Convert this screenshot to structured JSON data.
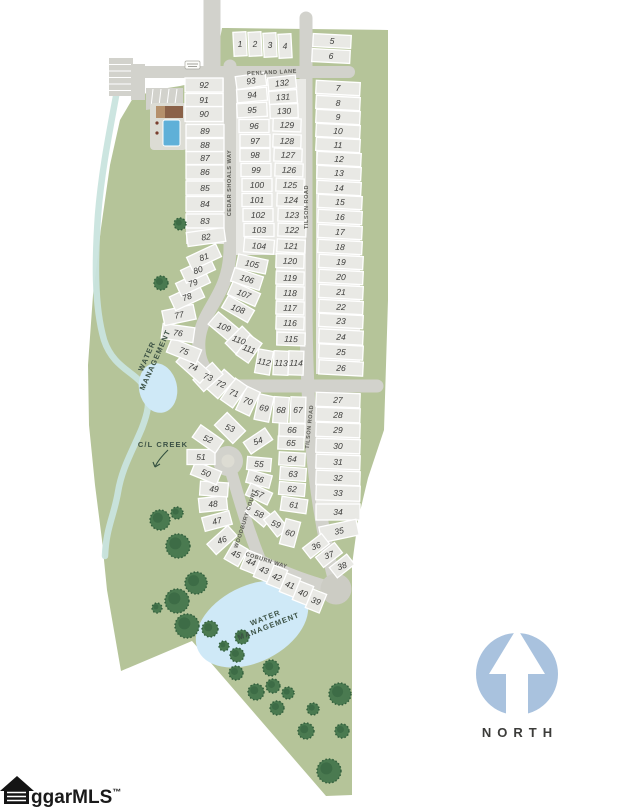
{
  "map": {
    "streets": [
      {
        "text": "PENLAND LANE",
        "x": 272,
        "y": 74,
        "rot": -3
      },
      {
        "text": "CEDAR SHOALS WAY",
        "x": 231,
        "y": 183,
        "rot": -90
      },
      {
        "text": "TILSON ROAD",
        "x": 308,
        "y": 207,
        "rot": -90
      },
      {
        "text": "TILSON ROAD",
        "x": 311,
        "y": 427,
        "rot": -84
      },
      {
        "text": "WOODBURY COURT",
        "x": 247,
        "y": 519,
        "rot": -72
      },
      {
        "text": "COBURN WAY",
        "x": 266,
        "y": 562,
        "rot": 17
      }
    ],
    "area_labels": [
      {
        "lines": [
          "WATER",
          "MANAGEMENT"
        ],
        "x": 151,
        "y": 358,
        "rot": -66
      },
      {
        "lines": [
          "WATER",
          "MANAGEMENT"
        ],
        "x": 267,
        "y": 622,
        "rot": -21
      },
      {
        "lines": [
          "C/L CREEK"
        ],
        "x": 163,
        "y": 444,
        "rot": 0
      }
    ],
    "north_label": "NORTH",
    "watermark_text": "ggarMLS",
    "watermark_tm": "™",
    "colors": {
      "parcel": "#b5c499",
      "road": "#d2d2cc",
      "lot": "#e9e9e5",
      "pond": "#cfe9f7",
      "creek": "#c9e4de",
      "pool": "#5fb0d8",
      "building": "#8a6148",
      "tree": "#4a7a50",
      "tree_dark": "#2f5c3a",
      "north_circle": "#a9c2de"
    },
    "lots": [
      [
        1,
        240,
        44,
        13,
        24,
        -3
      ],
      [
        2,
        255,
        44,
        13,
        24,
        -3
      ],
      [
        3,
        270,
        45,
        13,
        24,
        -3
      ],
      [
        4,
        285,
        46,
        13,
        24,
        -3
      ],
      [
        5,
        332,
        41,
        38,
        13,
        3
      ],
      [
        6,
        331,
        56,
        38,
        13,
        3
      ],
      [
        7,
        338,
        88,
        44,
        13,
        3
      ],
      [
        8,
        338,
        103,
        44,
        13,
        3
      ],
      [
        9,
        338,
        117,
        44,
        13,
        3
      ],
      [
        10,
        338,
        131,
        44,
        13,
        3
      ],
      [
        11,
        338,
        145,
        44,
        13,
        3
      ],
      [
        12,
        339,
        159,
        44,
        13,
        3
      ],
      [
        13,
        339,
        173,
        44,
        13,
        3
      ],
      [
        14,
        339,
        188,
        44,
        13,
        3
      ],
      [
        15,
        340,
        202,
        44,
        13,
        3
      ],
      [
        16,
        340,
        217,
        44,
        13,
        3
      ],
      [
        17,
        340,
        232,
        44,
        13,
        3
      ],
      [
        18,
        340,
        247,
        44,
        13,
        3
      ],
      [
        19,
        341,
        262,
        44,
        13,
        3
      ],
      [
        20,
        341,
        277,
        44,
        13,
        3
      ],
      [
        21,
        341,
        292,
        44,
        13,
        3
      ],
      [
        22,
        341,
        307,
        44,
        13,
        3
      ],
      [
        23,
        341,
        321,
        44,
        13,
        3
      ],
      [
        24,
        341,
        337,
        44,
        14,
        3
      ],
      [
        25,
        341,
        352,
        44,
        14,
        3
      ],
      [
        26,
        341,
        368,
        44,
        14,
        3
      ],
      [
        27,
        338,
        400,
        44,
        14,
        2
      ],
      [
        28,
        338,
        415,
        44,
        14,
        2
      ],
      [
        29,
        338,
        430,
        44,
        14,
        2
      ],
      [
        30,
        338,
        446,
        44,
        14,
        2
      ],
      [
        31,
        338,
        462,
        44,
        14,
        2
      ],
      [
        32,
        338,
        478,
        44,
        14,
        2
      ],
      [
        33,
        338,
        493,
        44,
        15,
        2
      ],
      [
        34,
        338,
        512,
        44,
        16,
        0
      ],
      [
        35,
        339,
        531,
        38,
        16,
        -12
      ],
      [
        36,
        316,
        546,
        24,
        13,
        -38
      ],
      [
        37,
        329,
        555,
        24,
        13,
        -38
      ],
      [
        38,
        342,
        566,
        22,
        13,
        -38
      ],
      [
        39,
        316,
        601,
        15,
        20,
        22
      ],
      [
        40,
        303,
        593,
        15,
        20,
        22
      ],
      [
        41,
        290,
        585,
        15,
        20,
        22
      ],
      [
        42,
        277,
        577,
        15,
        20,
        22
      ],
      [
        43,
        264,
        570,
        15,
        20,
        22
      ],
      [
        44,
        251,
        562,
        15,
        20,
        22
      ],
      [
        45,
        236,
        554,
        16,
        20,
        30
      ],
      [
        46,
        222,
        540,
        28,
        14,
        -42
      ],
      [
        47,
        217,
        521,
        28,
        14,
        -15
      ],
      [
        48,
        213,
        504,
        28,
        14,
        -6
      ],
      [
        49,
        214,
        489,
        28,
        14,
        4
      ],
      [
        50,
        206,
        473,
        28,
        14,
        22
      ],
      [
        51,
        201,
        457,
        28,
        15,
        0
      ],
      [
        52,
        208,
        439,
        28,
        15,
        35
      ],
      [
        53,
        230,
        428,
        26,
        18,
        45
      ],
      [
        54,
        258,
        441,
        26,
        14,
        -34
      ],
      [
        55,
        259,
        464,
        24,
        13,
        5
      ],
      [
        56,
        259,
        479,
        24,
        13,
        15
      ],
      [
        57,
        259,
        494,
        24,
        13,
        25
      ],
      [
        58,
        259,
        514,
        24,
        14,
        40
      ],
      [
        59,
        276,
        524,
        22,
        14,
        52
      ],
      [
        60,
        290,
        533,
        15,
        26,
        15
      ],
      [
        61,
        294,
        505,
        26,
        14,
        8
      ],
      [
        62,
        292,
        489,
        26,
        13,
        5
      ],
      [
        63,
        293,
        474,
        26,
        13,
        4
      ],
      [
        64,
        292,
        459,
        26,
        13,
        3
      ],
      [
        65,
        291,
        443,
        26,
        13,
        2
      ],
      [
        66,
        292,
        430,
        26,
        13,
        2
      ],
      [
        67,
        298,
        410,
        15,
        26,
        2
      ],
      [
        68,
        281,
        410,
        15,
        26,
        4
      ],
      [
        69,
        264,
        408,
        15,
        26,
        12
      ],
      [
        70,
        248,
        401,
        15,
        26,
        25
      ],
      [
        71,
        234,
        393,
        15,
        26,
        35
      ],
      [
        72,
        221,
        384,
        15,
        26,
        42
      ],
      [
        73,
        208,
        377,
        16,
        26,
        48
      ],
      [
        74,
        193,
        367,
        32,
        15,
        42
      ],
      [
        75,
        184,
        351,
        32,
        15,
        22
      ],
      [
        76,
        178,
        333,
        32,
        15,
        8
      ],
      [
        77,
        179,
        315,
        32,
        15,
        -12
      ],
      [
        78,
        187,
        297,
        32,
        15,
        -25
      ],
      [
        79,
        193,
        283,
        32,
        14,
        -25
      ],
      [
        80,
        198,
        270,
        32,
        14,
        -25
      ],
      [
        81,
        204,
        257,
        32,
        14,
        -25
      ],
      [
        82,
        206,
        237,
        38,
        14,
        -8
      ],
      [
        83,
        205,
        221,
        38,
        14,
        0
      ],
      [
        84,
        205,
        204,
        38,
        15,
        0
      ],
      [
        85,
        205,
        188,
        38,
        14,
        0
      ],
      [
        86,
        205,
        172,
        38,
        14,
        0
      ],
      [
        87,
        205,
        158,
        38,
        13,
        0
      ],
      [
        88,
        205,
        145,
        38,
        13,
        0
      ],
      [
        89,
        205,
        131,
        38,
        13,
        0
      ],
      [
        90,
        204,
        114,
        38,
        15,
        0
      ],
      [
        91,
        204,
        100,
        38,
        13,
        0
      ],
      [
        92,
        204,
        85,
        38,
        14,
        0
      ],
      [
        93,
        251,
        81,
        30,
        13,
        -8
      ],
      [
        94,
        252,
        95,
        30,
        13,
        -5
      ],
      [
        95,
        252,
        110,
        30,
        14,
        -3
      ],
      [
        96,
        254,
        126,
        30,
        13,
        0
      ],
      [
        97,
        255,
        141,
        30,
        13,
        0
      ],
      [
        98,
        255,
        155,
        30,
        13,
        0
      ],
      [
        99,
        256,
        170,
        30,
        13,
        0
      ],
      [
        100,
        257,
        185,
        30,
        13,
        0
      ],
      [
        101,
        257,
        200,
        30,
        13,
        0
      ],
      [
        102,
        258,
        215,
        30,
        13,
        0
      ],
      [
        103,
        259,
        230,
        30,
        13,
        0
      ],
      [
        104,
        259,
        246,
        30,
        14,
        5
      ],
      [
        105,
        252,
        264,
        30,
        14,
        12
      ],
      [
        106,
        247,
        279,
        30,
        14,
        18
      ],
      [
        107,
        244,
        294,
        30,
        14,
        24
      ],
      [
        108,
        238,
        309,
        30,
        14,
        30
      ],
      [
        109,
        224,
        327,
        28,
        16,
        40
      ],
      [
        110,
        239,
        340,
        15,
        24,
        45
      ],
      [
        111,
        249,
        349,
        15,
        24,
        35
      ],
      [
        112,
        264,
        362,
        15,
        24,
        10
      ],
      [
        113,
        281,
        363,
        15,
        24,
        3
      ],
      [
        114,
        296,
        363,
        15,
        24,
        2
      ],
      [
        115,
        291,
        339,
        28,
        13,
        2
      ],
      [
        116,
        290,
        323,
        28,
        13,
        2
      ],
      [
        117,
        290,
        308,
        28,
        13,
        2
      ],
      [
        118,
        290,
        293,
        28,
        13,
        2
      ],
      [
        119,
        290,
        278,
        28,
        13,
        2
      ],
      [
        120,
        290,
        261,
        28,
        14,
        2
      ],
      [
        121,
        291,
        246,
        28,
        13,
        3
      ],
      [
        122,
        292,
        230,
        28,
        13,
        2
      ],
      [
        123,
        292,
        215,
        28,
        13,
        2
      ],
      [
        124,
        291,
        200,
        28,
        13,
        2
      ],
      [
        125,
        290,
        185,
        28,
        13,
        2
      ],
      [
        126,
        289,
        170,
        28,
        13,
        2
      ],
      [
        127,
        288,
        155,
        28,
        13,
        2
      ],
      [
        128,
        287,
        141,
        28,
        13,
        2
      ],
      [
        129,
        287,
        125,
        28,
        13,
        2
      ],
      [
        130,
        284,
        111,
        28,
        14,
        -2
      ],
      [
        131,
        283,
        97,
        28,
        13,
        -4
      ],
      [
        132,
        282,
        83,
        28,
        13,
        -6
      ]
    ],
    "trees": [
      [
        180,
        224,
        6
      ],
      [
        161,
        283,
        7
      ],
      [
        160,
        520,
        10
      ],
      [
        177,
        513,
        6
      ],
      [
        178,
        546,
        12
      ],
      [
        196,
        583,
        11
      ],
      [
        177,
        601,
        12
      ],
      [
        157,
        608,
        5
      ],
      [
        187,
        626,
        12
      ],
      [
        210,
        629,
        8
      ],
      [
        242,
        637,
        7
      ],
      [
        224,
        646,
        5
      ],
      [
        237,
        655,
        7
      ],
      [
        236,
        673,
        7
      ],
      [
        271,
        668,
        8
      ],
      [
        273,
        686,
        7
      ],
      [
        256,
        692,
        8
      ],
      [
        288,
        693,
        6
      ],
      [
        277,
        708,
        7
      ],
      [
        313,
        709,
        6
      ],
      [
        340,
        694,
        11
      ],
      [
        306,
        731,
        8
      ],
      [
        342,
        731,
        7
      ],
      [
        329,
        771,
        12
      ]
    ]
  }
}
